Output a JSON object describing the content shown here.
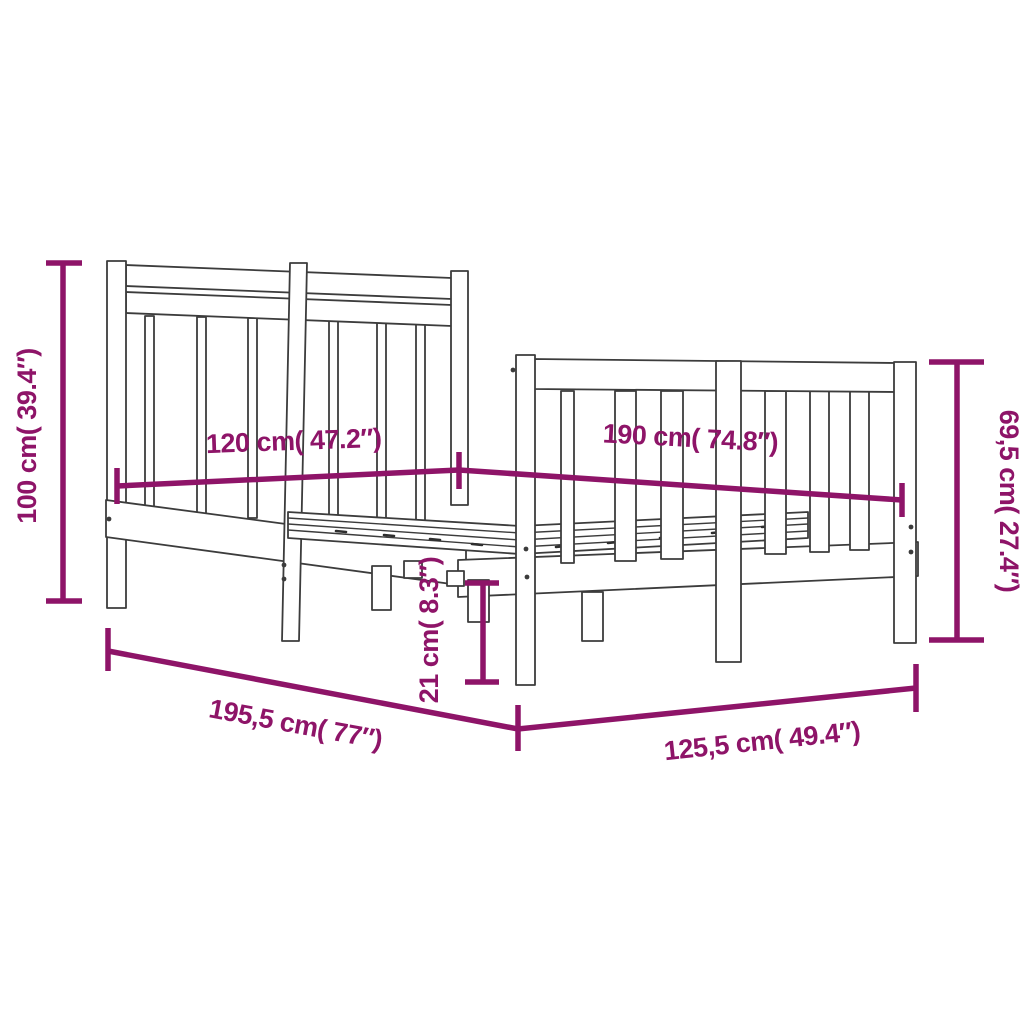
{
  "diagram": {
    "kind": "product-dimension-diagram",
    "subject": "wooden bed frame with headboard and footboard",
    "background": "#ffffff",
    "accent_color": "#8E1468",
    "outline_color": "#3C3C3C",
    "labels": {
      "height_left": "100 cm( 39.4″)",
      "width_top": "120 cm( 47.2″)",
      "length_top": "190 cm( 74.8″)",
      "height_right": "69,5 cm( 27.4″)",
      "leg_height": "21 cm( 8.3″)",
      "base_length": "195,5 cm( 77″)",
      "base_width": "125,5 cm( 49.4″)"
    },
    "dimensions": [
      {
        "name": "headboard height",
        "cm": "100",
        "inches": "39.4"
      },
      {
        "name": "bed width (top)",
        "cm": "120",
        "inches": "47.2"
      },
      {
        "name": "bed length (top)",
        "cm": "190",
        "inches": "74.8"
      },
      {
        "name": "footboard height",
        "cm": "69,5",
        "inches": "27.4"
      },
      {
        "name": "under-bed clearance",
        "cm": "21",
        "inches": "8.3"
      },
      {
        "name": "overall length",
        "cm": "195,5",
        "inches": "77"
      },
      {
        "name": "overall width",
        "cm": "125,5",
        "inches": "49.4"
      }
    ]
  }
}
